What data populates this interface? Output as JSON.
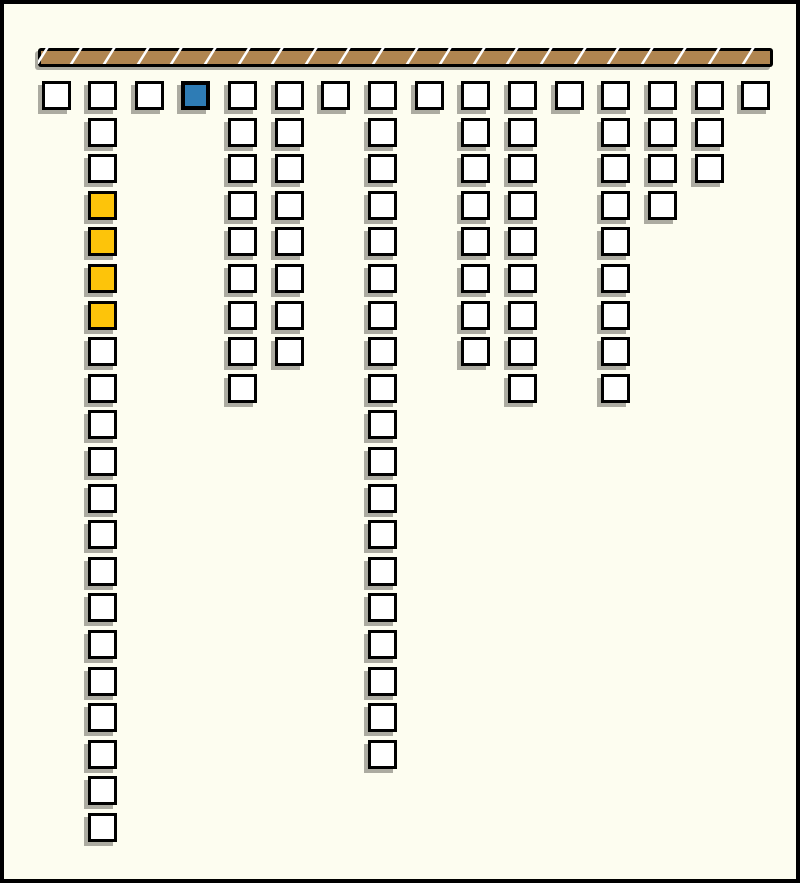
{
  "canvas": {
    "width": 800,
    "height": 883,
    "background_color": "#FDFDF0",
    "border_color": "#000000",
    "border_width_px": 4
  },
  "beam": {
    "left": 34,
    "top": 44,
    "width": 735,
    "height": 19,
    "frame_color": "#000000",
    "frame_px": 3,
    "fill_color": "#B08550",
    "divider_color": "#FFFFFF",
    "divider_count": 22,
    "divider_start_px": 3,
    "divider_pitch_px": 33.6,
    "divider_width_px": 3,
    "divider_skew_deg": -32,
    "shadow_color": "#ACABA1"
  },
  "grid": {
    "square_size_px": 29,
    "square_border_px": 3,
    "selected_border_px": 4,
    "first_col_x": 37.5,
    "col_pitch_px": 46.65,
    "first_row_y": 77,
    "row_pitch_px": 36.6,
    "border_color": "#000000",
    "cell_fill": "#FFFFFF",
    "selected_fill": "#2E7CB5",
    "highlight_fill": "#FDC40A",
    "shadow_color": "#ACABA1",
    "columns": [
      {
        "count": 1
      },
      {
        "count": 21,
        "highlight_rows": [
          3,
          4,
          5,
          6
        ]
      },
      {
        "count": 1
      },
      {
        "count": 1,
        "selected_rows": [
          0
        ]
      },
      {
        "count": 9
      },
      {
        "count": 8
      },
      {
        "count": 1
      },
      {
        "count": 19
      },
      {
        "count": 1
      },
      {
        "count": 8
      },
      {
        "count": 9
      },
      {
        "count": 1
      },
      {
        "count": 9
      },
      {
        "count": 4
      },
      {
        "count": 3
      },
      {
        "count": 1
      }
    ]
  }
}
